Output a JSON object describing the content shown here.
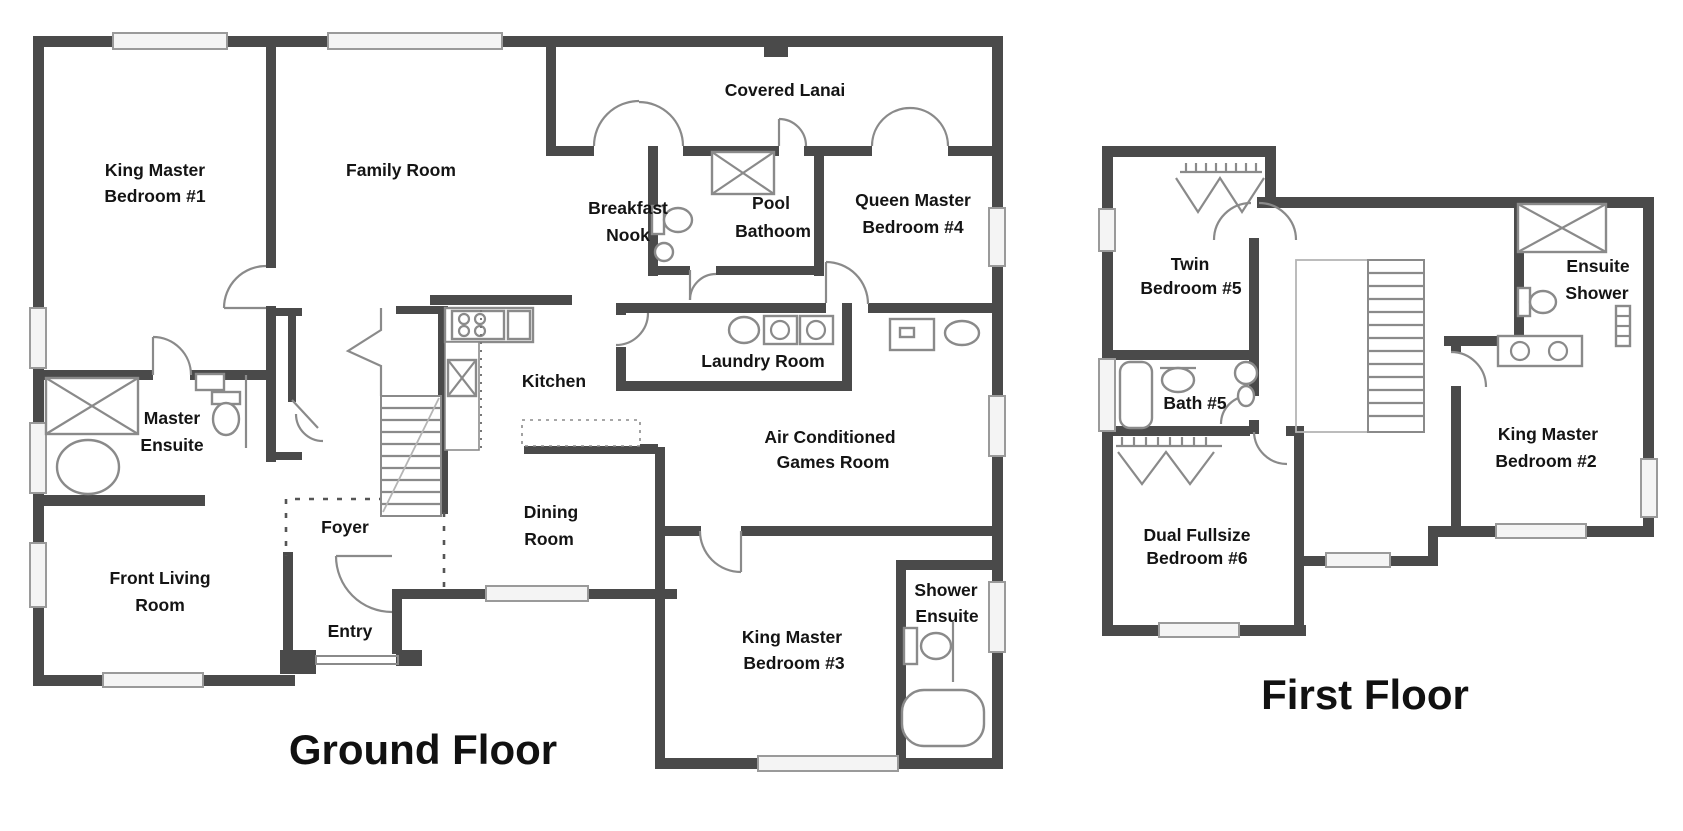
{
  "ground_floor": {
    "title": "Ground Floor",
    "rooms": {
      "king_master_bedroom_1": {
        "line1": "King Master",
        "line2": "Bedroom #1"
      },
      "family_room": {
        "line1": "Family Room"
      },
      "covered_lanai": {
        "line1": "Covered Lanai"
      },
      "breakfast_nook": {
        "line1": "Breakfast",
        "line2": "Nook"
      },
      "pool_bathroom": {
        "line1": "Pool",
        "line2": "Bathoom"
      },
      "queen_master_bedroom_4": {
        "line1": "Queen Master",
        "line2": "Bedroom #4"
      },
      "master_ensuite": {
        "line1": "Master",
        "line2": "Ensuite"
      },
      "kitchen": {
        "line1": "Kitchen"
      },
      "laundry_room": {
        "line1": "Laundry Room"
      },
      "games_room": {
        "line1": "Air Conditioned",
        "line2": "Games Room"
      },
      "foyer": {
        "line1": "Foyer"
      },
      "dining_room": {
        "line1": "Dining",
        "line2": "Room"
      },
      "front_living_room": {
        "line1": "Front Living",
        "line2": "Room"
      },
      "entry": {
        "line1": "Entry"
      },
      "king_master_bedroom_3": {
        "line1": "King Master",
        "line2": "Bedroom #3"
      },
      "shower_ensuite": {
        "line1": "Shower",
        "line2": "Ensuite"
      }
    }
  },
  "first_floor": {
    "title": "First Floor",
    "rooms": {
      "twin_bedroom_5": {
        "line1": "Twin",
        "line2": "Bedroom #5"
      },
      "bath_5": {
        "line1": "Bath #5"
      },
      "ensuite_shower": {
        "line1": "Ensuite",
        "line2": "Shower"
      },
      "king_master_bedroom_2": {
        "line1": "King Master",
        "line2": "Bedroom #2"
      },
      "dual_fullsize_bedroom_6": {
        "line1": "Dual Fullsize",
        "line2": "Bedroom #6"
      }
    }
  },
  "colors": {
    "wall": "#4a4a4a",
    "label": "#141414",
    "fixture": "#8a8a8a",
    "window_fill": "#f4f4f4",
    "background": "#ffffff"
  }
}
